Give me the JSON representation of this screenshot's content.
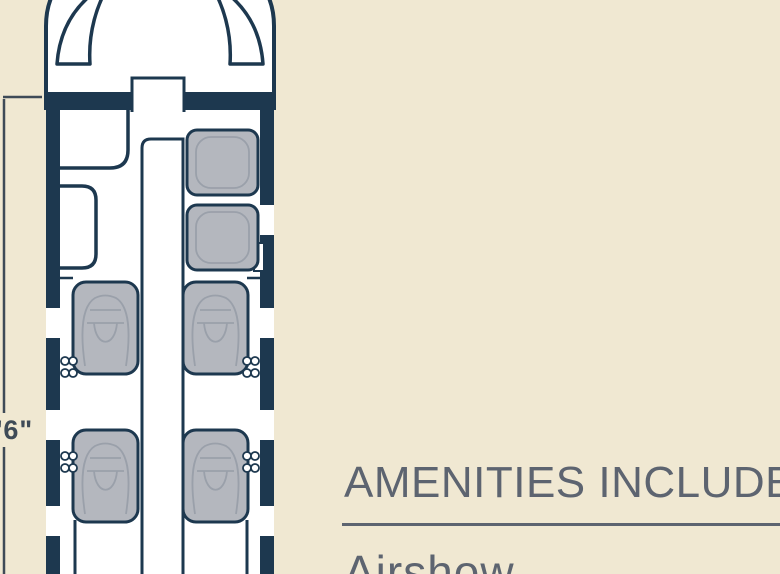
{
  "aircraft_plan": {
    "dimension_label": "'6\"",
    "club_seat_count": 4,
    "forward_seat_count": 2
  },
  "amenities": {
    "heading": "AMENITIES INCLUDE",
    "items": [
      "Airshow"
    ]
  },
  "colors": {
    "beige": "#f0e8d2",
    "navy": "#1d384f",
    "seat": "#b4b7be",
    "seatline": "#9aa0aa",
    "textgray": "#5d6470",
    "dimline": "#3e4a57"
  }
}
